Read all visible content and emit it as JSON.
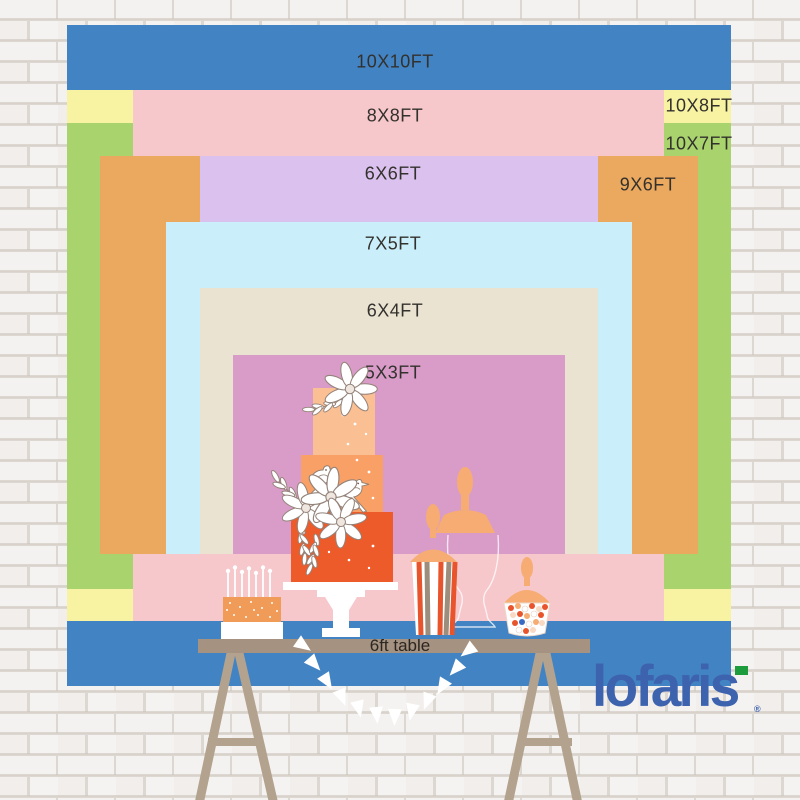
{
  "backdrop_chart": {
    "description": "backdrop size comparison",
    "sizes": [
      {
        "label": "10X10FT",
        "color": "#4283C3"
      },
      {
        "label": "8X8FT",
        "color": "#F6C7CB"
      },
      {
        "label": "10X8FT",
        "color": "#F7F3A2"
      },
      {
        "label": "10X7FT",
        "color": "#A9D46D"
      },
      {
        "label": "9X6FT",
        "color": "#EBA85F"
      },
      {
        "label": "6X6FT",
        "color": "#DBC2EE"
      },
      {
        "label": "7X5FT",
        "color": "#CBEFFA"
      },
      {
        "label": "6X4FT",
        "color": "#EAE3D2"
      },
      {
        "label": "5X3FT",
        "color": "#D99CC9"
      }
    ],
    "table_label": "6ft table"
  },
  "brand": {
    "logo_text": "lofaris",
    "registered_mark": "®",
    "logo_color": "#3E63AE",
    "accent_color": "#1C9C3C"
  }
}
